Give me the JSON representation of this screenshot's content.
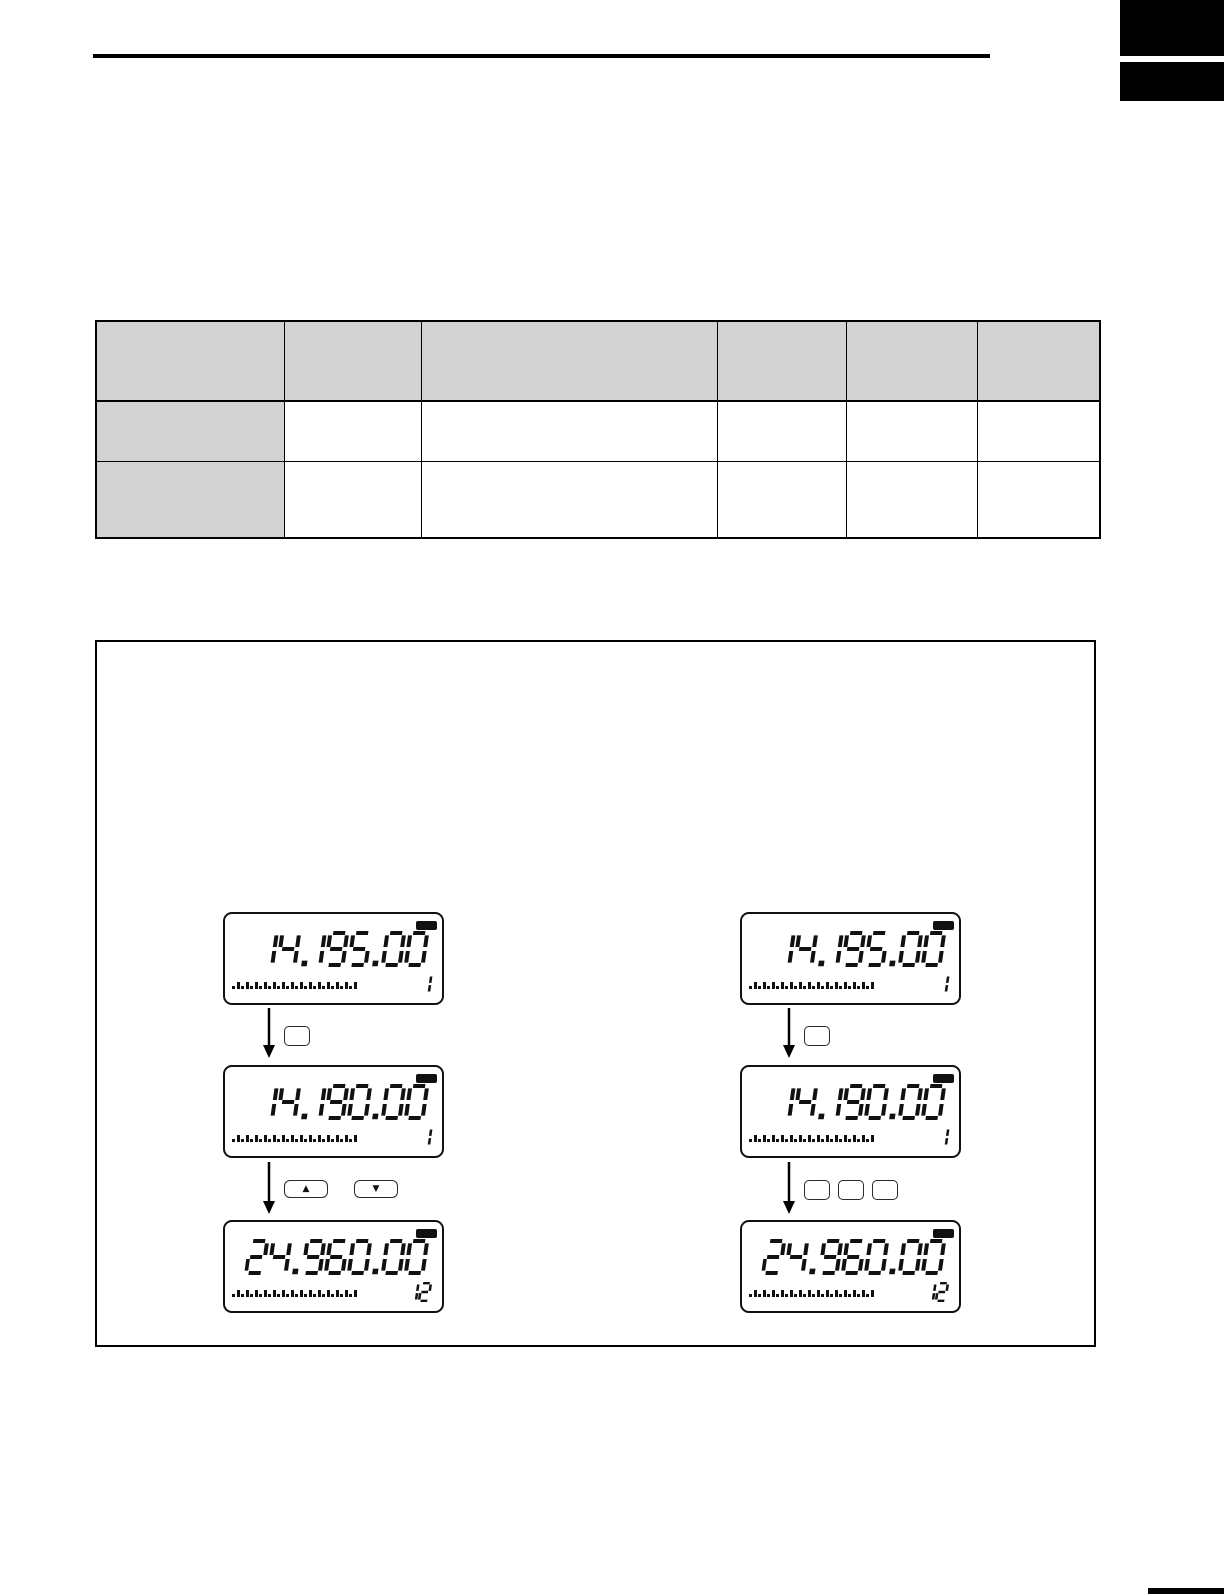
{
  "page": {
    "background": "#ffffff",
    "ink": "#000000",
    "table_header_fill": "#d2d2d2"
  },
  "table": {
    "columns": 6,
    "header_cells": [
      "",
      "",
      "",
      "",
      "",
      ""
    ],
    "body_rows": [
      {
        "row_header": "",
        "cells": [
          "",
          "",
          "",
          "",
          ""
        ]
      },
      {
        "row_header": "",
        "cells": [
          "",
          "",
          "",
          "",
          ""
        ]
      }
    ]
  },
  "figure": {
    "meter_tick_count": 28,
    "columns": [
      {
        "side": "left",
        "displays": [
          {
            "frequency": "14.195.00",
            "channel": "1"
          },
          {
            "frequency": "14.190.00",
            "channel": "1"
          },
          {
            "frequency": "24.960.00",
            "channel": "12"
          }
        ],
        "connectors": [
          {
            "buttons": [
              {
                "label": "",
                "style": "small"
              }
            ]
          },
          {
            "buttons": [
              {
                "label": "▲",
                "style": "wide"
              },
              {
                "label": "▼",
                "style": "wide"
              }
            ]
          }
        ]
      },
      {
        "side": "right",
        "displays": [
          {
            "frequency": "14.195.00",
            "channel": "1"
          },
          {
            "frequency": "14.190.00",
            "channel": "1"
          },
          {
            "frequency": "24.960.00",
            "channel": "12"
          }
        ],
        "connectors": [
          {
            "buttons": [
              {
                "label": "",
                "style": "small"
              }
            ]
          },
          {
            "buttons": [
              {
                "label": "",
                "style": "small"
              },
              {
                "label": "",
                "style": "small"
              },
              {
                "label": "",
                "style": "small"
              }
            ]
          }
        ]
      }
    ]
  }
}
